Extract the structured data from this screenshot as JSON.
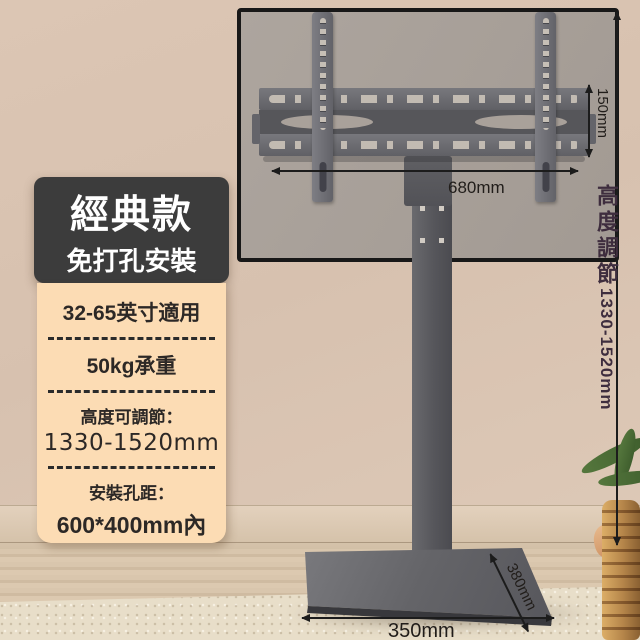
{
  "badge": {
    "title": "經典款",
    "subtitle": "免打孔安裝"
  },
  "specs": {
    "size_range": "32-65英寸適用",
    "load_capacity": "50kg承重",
    "height_label": "高度可調節：",
    "height_value": "1330-1520mm",
    "holes_label": "安裝孔距：",
    "holes_value": "600*400mm內"
  },
  "dimensions": {
    "bracket_width": "680mm",
    "bracket_height": "150mm",
    "height_adjust_label": "高度調節",
    "height_adjust_value": "1330-1520mm",
    "base_side": "380mm",
    "base_front": "350mm"
  },
  "colors": {
    "badge_bg": "#3c3c3c",
    "spec_bg": "#fcdcb4",
    "metal_gray": "#5a5a5e",
    "wall_beige": "#d9c3b1",
    "annotation": "#211d1a"
  }
}
